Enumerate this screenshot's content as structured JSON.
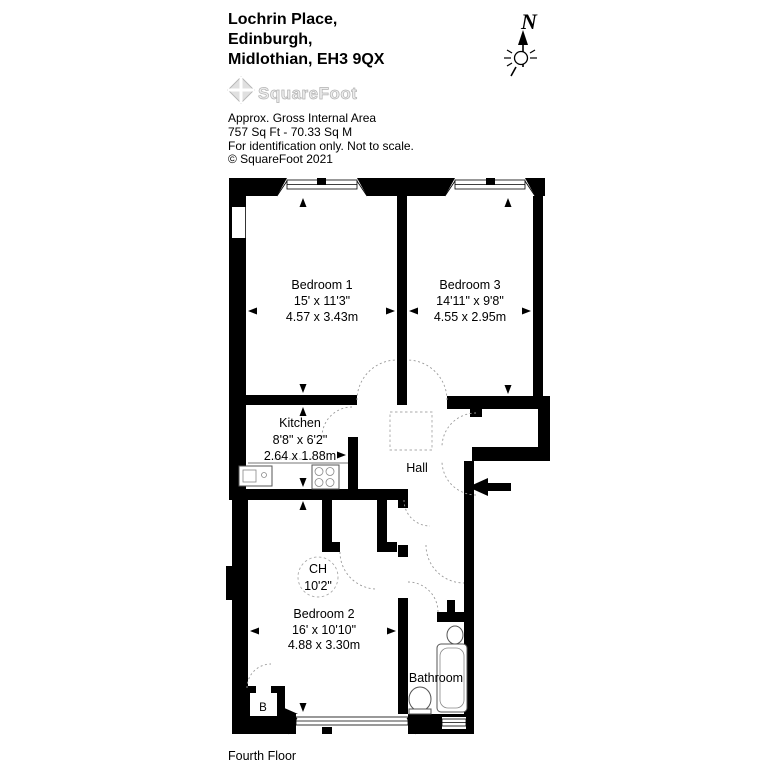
{
  "header": {
    "address_line1": "Lochrin Place,",
    "address_line2": "Edinburgh,",
    "address_line3": "Midlothian, EH3 9QX"
  },
  "logo": {
    "text": "SquareFoot"
  },
  "area_info": {
    "line1": "Approx. Gross Internal Area",
    "line2": "757 Sq Ft - 70.33 Sq M",
    "line3": "For identification only. Not to scale.",
    "line4": "© SquareFoot 2021"
  },
  "compass": {
    "north_label": "N"
  },
  "rooms": {
    "bedroom1": {
      "name": "Bedroom 1",
      "imperial": "15' x 11'3\"",
      "metric": "4.57 x 3.43m"
    },
    "bedroom3": {
      "name": "Bedroom 3",
      "imperial": "14'11\" x 9'8\"",
      "metric": "4.55 x 2.95m"
    },
    "kitchen": {
      "name": "Kitchen",
      "imperial": "8'8\" x 6'2\"",
      "metric": "2.64 x 1.88m"
    },
    "hall": {
      "name": "Hall"
    },
    "bedroom2": {
      "name": "Bedroom 2",
      "imperial": "16' x 10'10\"",
      "metric": "4.88 x 3.30m"
    },
    "bathroom": {
      "name": "Bathroom"
    },
    "boiler": {
      "name": "B"
    },
    "ceiling_height": {
      "line1": "CH",
      "line2": "10'2\""
    }
  },
  "footer": {
    "floor_label": "Fourth Floor"
  }
}
